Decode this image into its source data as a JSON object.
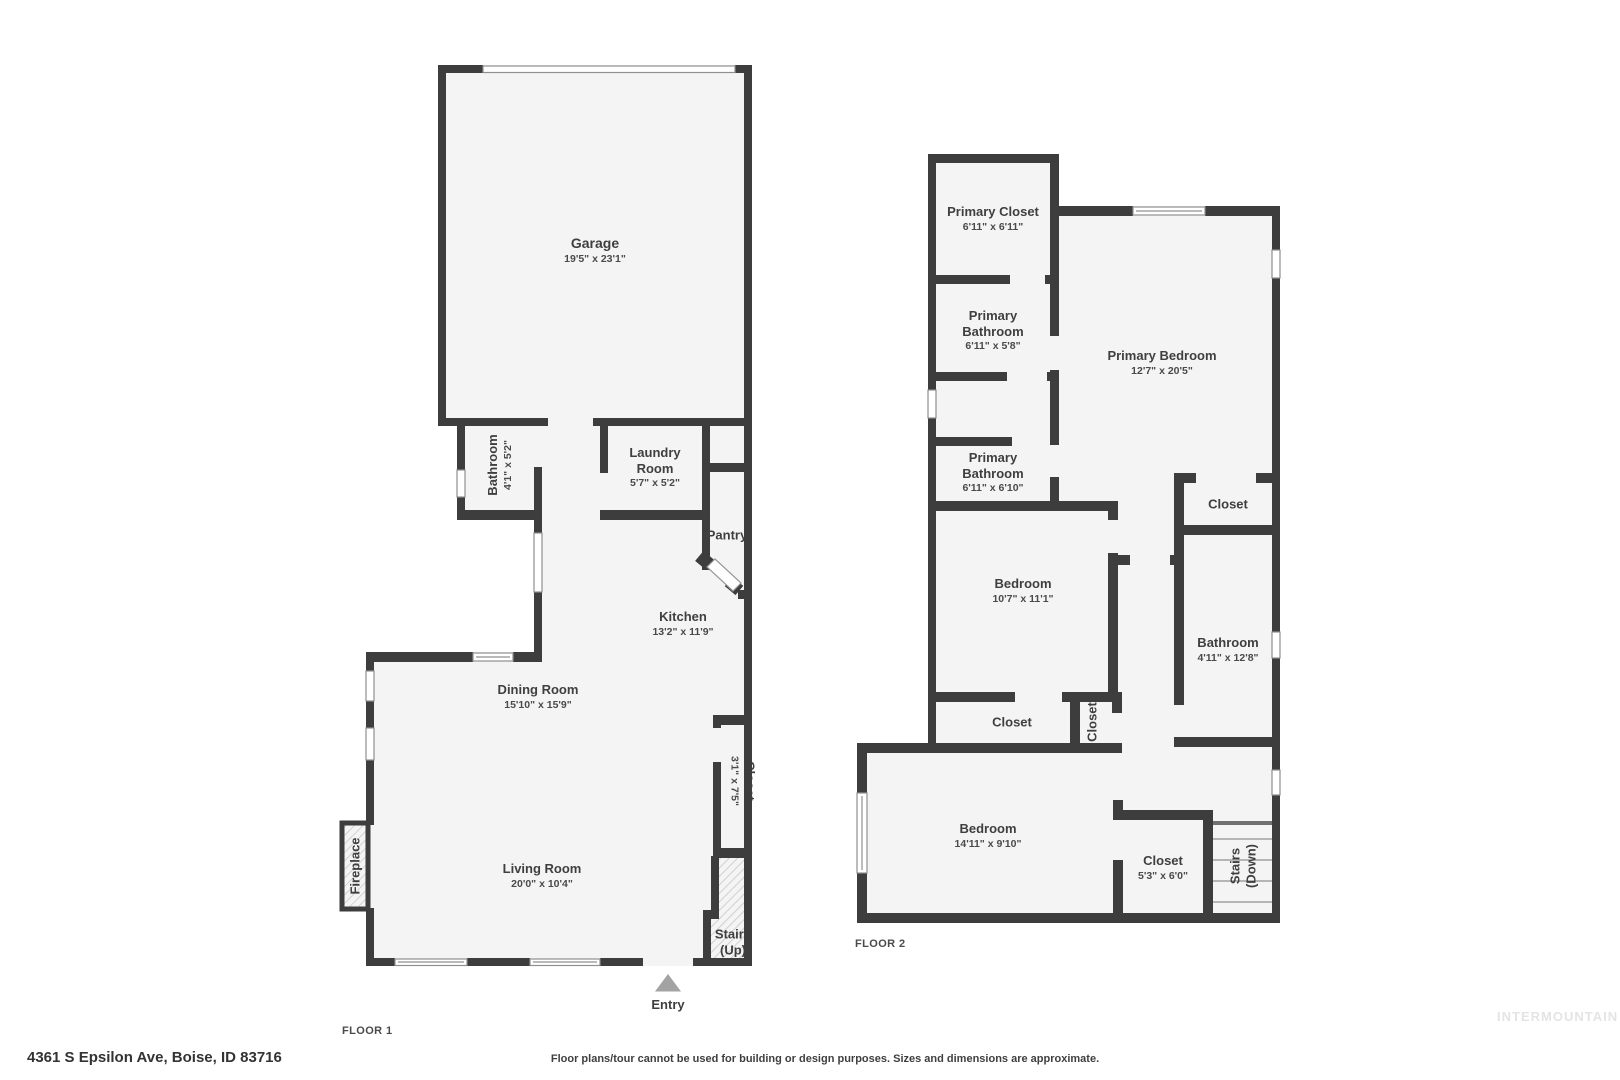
{
  "colors": {
    "wall": "#3d3d3d",
    "floor": "#f4f4f4",
    "hatch_line": "#c2c2c2",
    "window_frame": "#8f8f8f",
    "entry_arrow": "#a3a3a3"
  },
  "floor1": {
    "label": "FLOOR 1",
    "rooms": {
      "garage": {
        "name": "Garage",
        "dims": "19'5\" x 23'1\""
      },
      "bathroom": {
        "name": "Bathroom",
        "dims": "4'1\" x 5'2\""
      },
      "laundry": {
        "name": "Laundry Room",
        "dims": "5'7\" x 5'2\""
      },
      "pantry": {
        "name": "Pantry"
      },
      "kitchen": {
        "name": "Kitchen",
        "dims": "13'2\" x 11'9\""
      },
      "dining": {
        "name": "Dining Room",
        "dims": "15'10\" x 15'9\""
      },
      "closet": {
        "name": "Closet",
        "dims": "3'1\" x 7'5\""
      },
      "living": {
        "name": "Living Room",
        "dims": "20'0\" x 10'4\""
      },
      "fireplace": {
        "name": "Fireplace"
      },
      "stairs": {
        "line1": "Stairs",
        "line2": "(Up)"
      },
      "entry": {
        "name": "Entry"
      }
    }
  },
  "floor2": {
    "label": "FLOOR 2",
    "rooms": {
      "primary_closet": {
        "name": "Primary Closet",
        "dims": "6'11\" x 6'11\""
      },
      "primary_bathroom_1": {
        "name": "Primary Bathroom",
        "dims": "6'11\" x 5'8\""
      },
      "primary_bathroom_2": {
        "name": "Primary Bathroom",
        "dims": "6'11\" x 6'10\""
      },
      "primary_bedroom": {
        "name": "Primary Bedroom",
        "dims": "12'7\" x 20'5\""
      },
      "closet_top": {
        "name": "Closet"
      },
      "bathroom": {
        "name": "Bathroom",
        "dims": "4'11\" x 12'8\""
      },
      "bedroom_mid": {
        "name": "Bedroom",
        "dims": "10'7\" x 11'1\""
      },
      "closet_h": {
        "name": "Closet"
      },
      "closet_v": {
        "name": "Closet"
      },
      "bedroom_bottom": {
        "name": "Bedroom",
        "dims": "14'11\" x 9'10\""
      },
      "closet_b": {
        "name": "Closet",
        "dims": "5'3\" x 6'0\""
      },
      "stairs": {
        "line1": "Stairs",
        "line2": "(Down)"
      }
    }
  },
  "footer": {
    "address": "4361 S Epsilon Ave, Boise, ID 83716",
    "disclaimer": "Floor plans/tour cannot be used for building or design purposes. Sizes and dimensions are approximate.",
    "watermark": "INTERMOUNTAIN"
  }
}
